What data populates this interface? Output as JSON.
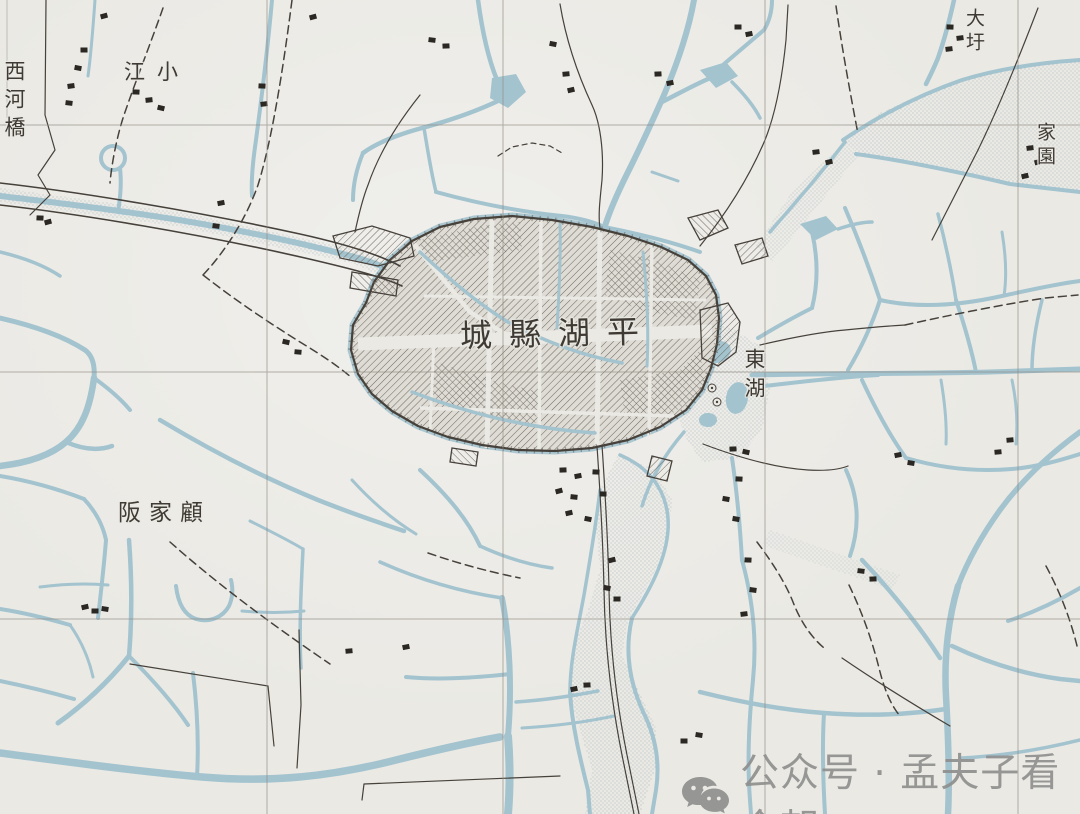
{
  "map": {
    "labels": {
      "city": "城縣湖平",
      "xihe_bridge": "西河橋",
      "xiao_jiang": "江小",
      "da_wei": "大圩",
      "jia_yuan": "家園",
      "dong_hu": "東湖",
      "gu_jia_ban": "阪家顧"
    },
    "colors": {
      "paper": "#eae9e4",
      "water": "#a3c3cf",
      "stipple": "#93a5ad",
      "ink": "#46413a",
      "inkSoft": "#5a544b",
      "grid": "#8f8a80",
      "hatch": "#6f6a60",
      "building": "#2b2722",
      "label": "#3f3a33",
      "watermark": "#8f8f8f"
    }
  },
  "watermark": {
    "icon": "wechat",
    "text": "公众号 · 孟夫子看今朝"
  }
}
